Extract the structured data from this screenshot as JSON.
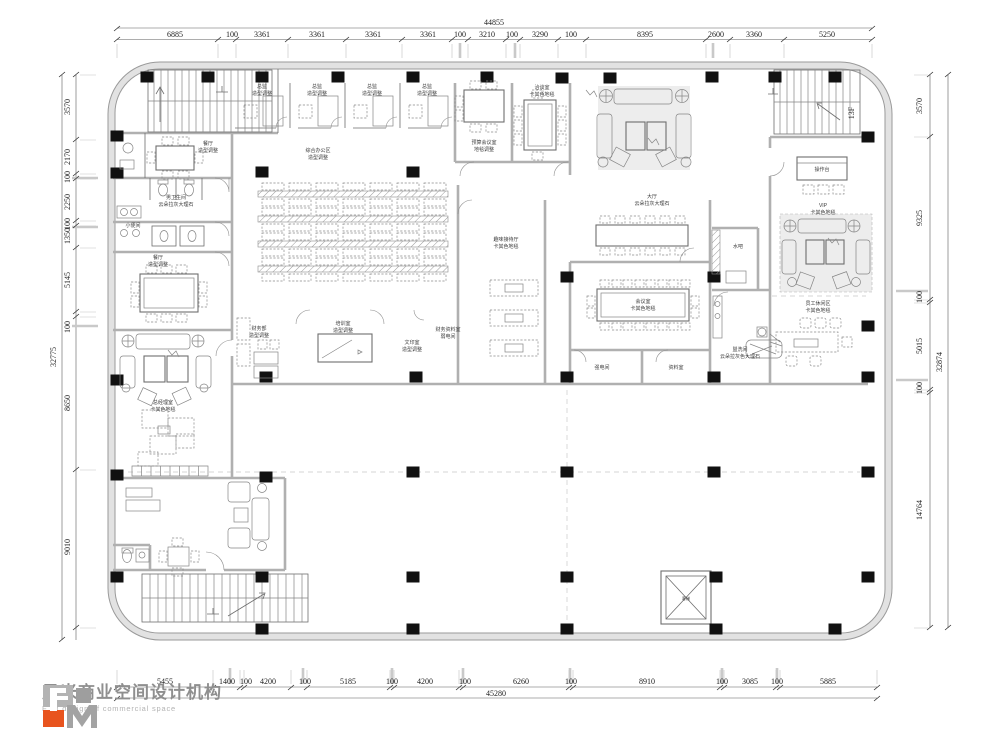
{
  "meta": {
    "floor_tag": "13F"
  },
  "logo": {
    "company_cn": "风米商业空间设计机构",
    "company_en": "F. M design of commercial space",
    "orange": "#e8541e",
    "gray": "#9e9e9e"
  },
  "dimensions": {
    "top": {
      "total": "44855",
      "segments": [
        "6885",
        "100",
        "3361",
        "3361",
        "3361",
        "3361",
        "100",
        "3210",
        "100",
        "3290",
        "100",
        "8395",
        "2600",
        "3360",
        "5250"
      ]
    },
    "bottom": {
      "total": "45280",
      "segments": [
        "5455",
        "1400",
        "100",
        "4200",
        "100",
        "5185",
        "100",
        "4200",
        "100",
        "6260",
        "100",
        "8910",
        "100",
        "3085",
        "100",
        "5885"
      ]
    },
    "left": {
      "total": "32775",
      "segments": [
        "3570",
        "2170",
        "100",
        "2250",
        "100",
        "1350",
        "5145",
        "100",
        "8650",
        "9010"
      ]
    },
    "right": {
      "total": "32874",
      "segments": [
        "3570",
        "9325",
        "100",
        "5015",
        "100",
        "14764"
      ]
    }
  },
  "rooms": {
    "exec1": [
      "总监",
      "造型调整"
    ],
    "exec2": [
      "总监",
      "造型调整"
    ],
    "exec3": [
      "总监",
      "造型调整"
    ],
    "exec4": [
      "总监",
      "造型调整"
    ],
    "open_office": [
      "综合办公区",
      "造型调整"
    ],
    "dining1": [
      "餐厅",
      "造型调整"
    ],
    "mens_wc": [
      "男卫生间",
      "云朵拉灰大理石"
    ],
    "urinal": [
      "小便间"
    ],
    "dining2": [
      "餐厅",
      "造型调整"
    ],
    "budget_meeting": [
      "预算会议室",
      "地毯调整"
    ],
    "negotiation": [
      "洽谈室",
      "卡其色地毯"
    ],
    "hall": [
      "大厅",
      "云朵拉灰大理石"
    ],
    "fun_reception": [
      "趣味接待厅",
      "卡其色地毯"
    ],
    "conference": [
      "会议室",
      "卡其色地毯"
    ],
    "strong_power": [
      "强电间"
    ],
    "archive": [
      "资料室"
    ],
    "washroom": [
      "盥洗间",
      "云朵拉灰色大理石"
    ],
    "water_bar": [
      "水吧"
    ],
    "counter": [
      "操作台"
    ],
    "vip": [
      "VIP",
      "卡其色地毯"
    ],
    "staff": [
      "员工休闲区",
      "卡其色地毯"
    ],
    "gm_office": [
      "总经理室",
      "卡其色地毯"
    ],
    "finance": [
      "财务部",
      "造型调整"
    ],
    "training": [
      "培训室",
      "造型调整"
    ],
    "print_room": [
      "文印室",
      "造型调整"
    ],
    "fin_archive": [
      "财务资料室",
      "弱电间"
    ],
    "elevator": [
      "客梯"
    ]
  }
}
